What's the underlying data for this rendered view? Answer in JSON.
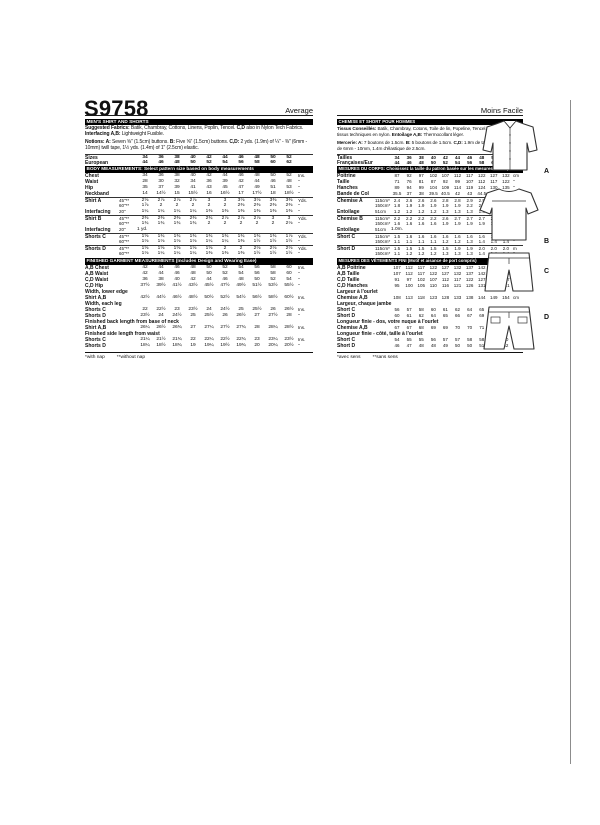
{
  "header": {
    "pattern_number": "S9758",
    "difficulty_en": "Average",
    "difficulty_fr": "Moins Facile"
  },
  "english": {
    "title_bar": "MEN'S SHIRT AND SHORTS",
    "fabrics": [
      {
        "b": 1,
        "t": "Suggested Fabrics: "
      },
      {
        "t": "Batik, Chambray, Cottons, Linens, Poplin, Tencel. "
      },
      {
        "b": 1,
        "t": "C,D"
      },
      {
        "t": " also in Nylon Tech Fabrics. "
      },
      {
        "b": 1,
        "t": "Interfacing A,B: "
      },
      {
        "t": "Lightweight Fusible."
      }
    ],
    "notions": [
      {
        "b": 1,
        "t": "Notions: A: "
      },
      {
        "t": "Seven ⅝\" (1.5cm) buttons. "
      },
      {
        "b": 1,
        "t": "B: "
      },
      {
        "t": "Five ⅝\" (1.5cm) buttons. "
      },
      {
        "b": 1,
        "t": "C,D: "
      },
      {
        "t": "2 yds. (1.9m) of ¼\" - ⅜\" (6mm - 10mm) twill tape, 1½ yds. (1.4m) of 1\" (2.5cm) elastic."
      }
    ],
    "rows": [
      {
        "t": "data",
        "b": true,
        "rule": true,
        "label": "Sizes",
        "sub": "",
        "values": [
          "34",
          "36",
          "38",
          "40",
          "42",
          "44",
          "46",
          "48",
          "50",
          "52"
        ],
        "unit": ""
      },
      {
        "t": "data",
        "b": true,
        "label": "European",
        "sub": "",
        "values": [
          "44",
          "46",
          "48",
          "50",
          "52",
          "54",
          "56",
          "58",
          "60",
          "62"
        ],
        "unit": ""
      },
      {
        "t": "bar",
        "text": "BODY MEASUREMENTS: Select pattern size based on body measurements"
      },
      {
        "t": "data",
        "label": "Chest",
        "sub": "",
        "values": [
          "34",
          "36",
          "38",
          "40",
          "42",
          "44",
          "46",
          "48",
          "50",
          "52"
        ],
        "unit": "Ins."
      },
      {
        "t": "data",
        "label": "Waist",
        "sub": "",
        "values": [
          "28",
          "30",
          "32",
          "34",
          "36",
          "39",
          "42",
          "44",
          "46",
          "48"
        ],
        "unit": "\""
      },
      {
        "t": "data",
        "label": "Hip",
        "sub": "",
        "values": [
          "35",
          "37",
          "39",
          "41",
          "43",
          "45",
          "47",
          "49",
          "51",
          "53"
        ],
        "unit": "\""
      },
      {
        "t": "data",
        "label": "Neckband",
        "sub": "",
        "values": [
          "14",
          "14½",
          "15",
          "15½",
          "16",
          "16½",
          "17",
          "17½",
          "18",
          "18½"
        ],
        "unit": "\""
      },
      {
        "t": "data",
        "rule": true,
        "label": "Shirt A",
        "sub": "45\"**",
        "values": [
          "2⅝",
          "2⅞",
          "2⅞",
          "2⅞",
          "3",
          "3",
          "3⅛",
          "3⅛",
          "3⅜",
          "3⅜"
        ],
        "unit": "Yds."
      },
      {
        "t": "data",
        "label": "",
        "sub": "60\"**",
        "values": [
          "1⅞",
          "2",
          "2",
          "2",
          "2",
          "2",
          "2⅜",
          "2⅜",
          "2⅜",
          "2⅜"
        ],
        "unit": "\""
      },
      {
        "t": "data",
        "label": "Interfacing",
        "sub": "20\"",
        "values": [
          "1¼",
          "1¼",
          "1¼",
          "1¼",
          "1⅜",
          "1⅜",
          "1⅜",
          "1⅜",
          "1⅜",
          "1⅜"
        ],
        "unit": "\""
      },
      {
        "t": "data",
        "rule": true,
        "label": "Shirt B",
        "sub": "45\"**",
        "values": [
          "2⅜",
          "2⅜",
          "2⅜",
          "2⅜",
          "2¾",
          "2⅞",
          "2⅞",
          "2⅞",
          "3",
          "3"
        ],
        "unit": "Yds."
      },
      {
        "t": "data",
        "label": "",
        "sub": "60\"**",
        "values": [
          "1¾",
          "1¾",
          "1¾",
          "1¾",
          "2",
          "2",
          "2",
          "2",
          "2",
          "2⅛"
        ],
        "unit": "\""
      },
      {
        "t": "data",
        "label": "Interfacing",
        "sub": "20\"",
        "span": "1 yd.",
        "unit": ""
      },
      {
        "t": "data",
        "rule": true,
        "label": "Shorts C",
        "sub": "45\"**",
        "values": [
          "1⅝",
          "1¾",
          "1¾",
          "1¾",
          "1¾",
          "1¾",
          "1¾",
          "1¾",
          "1¾",
          "1⅞"
        ],
        "unit": "Yds."
      },
      {
        "t": "data",
        "label": "",
        "sub": "60\"**",
        "values": [
          "1⅛",
          "1⅛",
          "1⅛",
          "1⅛",
          "1¼",
          "1¼",
          "1⅜",
          "1½",
          "1½",
          "1½"
        ],
        "unit": "\""
      },
      {
        "t": "data",
        "rule": true,
        "label": "Shorts D",
        "sub": "45\"**",
        "values": [
          "1⅝",
          "1⅝",
          "1⅝",
          "1⅝",
          "1⅝",
          "2",
          "2",
          "2⅛",
          "2⅛",
          "2⅛"
        ],
        "unit": "Yds."
      },
      {
        "t": "data",
        "label": "",
        "sub": "60\"**",
        "values": [
          "1⅛",
          "1¼",
          "1¼",
          "1¼",
          "1⅜",
          "1⅜",
          "1⅜",
          "1½",
          "1½",
          "1½"
        ],
        "unit": "\""
      },
      {
        "t": "bar",
        "text": "FINISHED GARMENT MEASUREMENTS (Includes Design and Wearing Ease)"
      },
      {
        "t": "data",
        "label": "A,B Chest",
        "sub": "",
        "values": [
          "42",
          "44",
          "46",
          "48",
          "50",
          "52",
          "54",
          "56",
          "58",
          "60"
        ],
        "unit": "Ins."
      },
      {
        "t": "data",
        "label": "A,B Waist",
        "sub": "",
        "values": [
          "42",
          "44",
          "46",
          "48",
          "50",
          "52",
          "54",
          "56",
          "58",
          "60"
        ],
        "unit": "\""
      },
      {
        "t": "data",
        "label": "C,D Waist",
        "sub": "",
        "values": [
          "36",
          "38",
          "40",
          "42",
          "44",
          "46",
          "48",
          "50",
          "52",
          "54"
        ],
        "unit": "\""
      },
      {
        "t": "data",
        "label": "C,D Hip",
        "sub": "",
        "values": [
          "37½",
          "39½",
          "41½",
          "43½",
          "45½",
          "47½",
          "49½",
          "51½",
          "53½",
          "55½"
        ],
        "unit": "\""
      },
      {
        "t": "sub",
        "text": "Width, lower edge"
      },
      {
        "t": "data",
        "label": "Shirt A,B",
        "sub": "",
        "values": [
          "42½",
          "44½",
          "46½",
          "48½",
          "50½",
          "52½",
          "54½",
          "56½",
          "58½",
          "60½"
        ],
        "unit": "Ins."
      },
      {
        "t": "sub",
        "text": "Width, each leg"
      },
      {
        "t": "data",
        "label": "Shorts C",
        "sub": "",
        "values": [
          "22",
          "22½",
          "23",
          "23½",
          "24",
          "24½",
          "25",
          "25½",
          "26",
          "26½"
        ],
        "unit": "Ins."
      },
      {
        "t": "data",
        "label": "Shorts D",
        "sub": "",
        "values": [
          "23½",
          "24",
          "24½",
          "25",
          "25½",
          "26",
          "26½",
          "27",
          "27½",
          "28"
        ],
        "unit": "\""
      },
      {
        "t": "sub",
        "text": "Finished back length from base of neck"
      },
      {
        "t": "data",
        "label": "Shirt A,B",
        "sub": "",
        "values": [
          "26¼",
          "26½",
          "26¾",
          "27",
          "27¼",
          "27½",
          "27¾",
          "28",
          "28¼",
          "28½"
        ],
        "unit": "Ins."
      },
      {
        "t": "sub",
        "text": "Finished side length from waist"
      },
      {
        "t": "data",
        "label": "Shorts C",
        "sub": "",
        "values": [
          "21¼",
          "21½",
          "21¾",
          "22",
          "22¼",
          "22½",
          "22¾",
          "23",
          "23¼",
          "23½"
        ],
        "unit": "Ins."
      },
      {
        "t": "data",
        "label": "Shorts D",
        "sub": "",
        "values": [
          "18¼",
          "18½",
          "18¾",
          "19",
          "19¼",
          "19½",
          "19¾",
          "20",
          "20¼",
          "20½"
        ],
        "unit": "\""
      },
      {
        "t": "note",
        "n1": "*with nap",
        "n2": "**without nap"
      }
    ]
  },
  "french": {
    "title_bar": "CHEMISE ET SHORT POUR HOMMES",
    "fabrics": [
      {
        "b": 1,
        "t": "Tissus Conseillés: "
      },
      {
        "t": "Batik, Chambray, Cotons, Toile de lin, Popeline, Tencel. "
      },
      {
        "b": 1,
        "t": "C,D"
      },
      {
        "t": " aussi en tissus techniques en nylon. "
      },
      {
        "b": 1,
        "t": "Entoilage A,B: "
      },
      {
        "t": "Thermocollant léger."
      }
    ],
    "notions": [
      {
        "b": 1,
        "t": "Mercerie: A: "
      },
      {
        "t": "7 boutons de 1.5cm. "
      },
      {
        "b": 1,
        "t": "B: "
      },
      {
        "t": "5 boutons de 1.5cm. "
      },
      {
        "b": 1,
        "t": "C,D: "
      },
      {
        "t": "1.9m de talonnette de coton de 6mm - 10mm, 1.4m d'élastique de 2.5cm."
      }
    ],
    "rows": [
      {
        "t": "data",
        "b": true,
        "rule": true,
        "label": "Tailles",
        "sub": "",
        "values": [
          "34",
          "36",
          "38",
          "40",
          "42",
          "44",
          "46",
          "48",
          "50",
          "52"
        ],
        "unit": ""
      },
      {
        "t": "data",
        "b": true,
        "label": "Françaises/Eur",
        "sub": "",
        "values": [
          "44",
          "46",
          "48",
          "50",
          "52",
          "54",
          "56",
          "58",
          "60",
          "62"
        ],
        "unit": ""
      },
      {
        "t": "bar",
        "text": "MESURES DU CORPS: Choisissez la taille du patron basée sur les mesures du corps"
      },
      {
        "t": "data",
        "label": "Poitrine",
        "sub": "",
        "values": [
          "87",
          "92",
          "97",
          "102",
          "107",
          "112",
          "117",
          "122",
          "127",
          "132"
        ],
        "unit": "cm"
      },
      {
        "t": "data",
        "label": "Taille",
        "sub": "",
        "values": [
          "71",
          "76",
          "81",
          "87",
          "92",
          "99",
          "107",
          "112",
          "117",
          "122"
        ],
        "unit": "\""
      },
      {
        "t": "data",
        "label": "Hanches",
        "sub": "",
        "values": [
          "89",
          "94",
          "99",
          "104",
          "109",
          "114",
          "119",
          "124",
          "130",
          "135"
        ],
        "unit": "\""
      },
      {
        "t": "data",
        "label": "Bande de Col",
        "sub": "",
        "values": [
          "35.5",
          "37",
          "38",
          "39.5",
          "40.5",
          "42",
          "43",
          "44.5",
          "45.5",
          "47"
        ],
        "unit": "\""
      },
      {
        "t": "data",
        "rule": true,
        "label": "Chemise A",
        "sub": "115cm*",
        "values": [
          "2.4",
          "2.6",
          "2.6",
          "2.6",
          "2.8",
          "2.8",
          "2.9",
          "2.9",
          "3.0",
          "3.0"
        ],
        "unit": "m"
      },
      {
        "t": "data",
        "label": "",
        "sub": "150cm*",
        "values": [
          "1.8",
          "1.9",
          "1.9",
          "1.9",
          "1.9",
          "1.9",
          "2.2",
          "2.2",
          "2.2",
          "2.2"
        ],
        "unit": "\""
      },
      {
        "t": "data",
        "label": "Entoilage",
        "sub": "51cm",
        "values": [
          "1.2",
          "1.2",
          "1.2",
          "1.2",
          "1.3",
          "1.3",
          "1.3",
          "1.3",
          "1.3",
          "1.3"
        ],
        "unit": "\""
      },
      {
        "t": "data",
        "rule": true,
        "label": "Chemise B",
        "sub": "115cm*",
        "values": [
          "2.2",
          "2.2",
          "2.2",
          "2.2",
          "2.6",
          "2.7",
          "2.7",
          "2.7",
          "2.8",
          "2.8"
        ],
        "unit": "m"
      },
      {
        "t": "data",
        "label": "",
        "sub": "150cm*",
        "values": [
          "1.6",
          "1.6",
          "1.6",
          "1.6",
          "1.9",
          "1.9",
          "1.9",
          "1.9",
          "1.9",
          "2.0"
        ],
        "unit": "\""
      },
      {
        "t": "data",
        "label": "Entoilage",
        "sub": "51cm",
        "span": "1.0m.",
        "unit": ""
      },
      {
        "t": "data",
        "rule": true,
        "label": "Short C",
        "sub": "115cm*",
        "values": [
          "1.5",
          "1.6",
          "1.6",
          "1.6",
          "1.6",
          "1.6",
          "1.6",
          "1.6",
          "1.6",
          "1.8"
        ],
        "unit": "m"
      },
      {
        "t": "data",
        "label": "",
        "sub": "150cm*",
        "values": [
          "1.1",
          "1.1",
          "1.1",
          "1.1",
          "1.2",
          "1.2",
          "1.3",
          "1.4",
          "1.4",
          "1.4"
        ],
        "unit": "\""
      },
      {
        "t": "data",
        "rule": true,
        "label": "Short D",
        "sub": "115cm*",
        "values": [
          "1.5",
          "1.5",
          "1.5",
          "1.5",
          "1.5",
          "1.9",
          "1.9",
          "2.0",
          "2.0",
          "2.0"
        ],
        "unit": "m"
      },
      {
        "t": "data",
        "label": "",
        "sub": "150cm*",
        "values": [
          "1.1",
          "1.2",
          "1.2",
          "1.2",
          "1.3",
          "1.3",
          "1.3",
          "1.4",
          "1.4",
          "1.4"
        ],
        "unit": "\""
      },
      {
        "t": "bar",
        "text": "MESURES DES VÊTEMENTS FINI (Motif et aisance de port compris)"
      },
      {
        "t": "data",
        "label": "A,B Poitrine",
        "sub": "",
        "values": [
          "107",
          "112",
          "117",
          "122",
          "127",
          "132",
          "137",
          "142",
          "147",
          "152"
        ],
        "unit": "cm"
      },
      {
        "t": "data",
        "label": "A,B Taille",
        "sub": "",
        "values": [
          "107",
          "112",
          "117",
          "122",
          "127",
          "132",
          "137",
          "142",
          "147",
          "152"
        ],
        "unit": "\""
      },
      {
        "t": "data",
        "label": "C,D Taille",
        "sub": "",
        "values": [
          "91",
          "97",
          "102",
          "107",
          "112",
          "117",
          "122",
          "127",
          "132",
          "137"
        ],
        "unit": "\""
      },
      {
        "t": "data",
        "label": "C,D Hanches",
        "sub": "",
        "values": [
          "95",
          "100",
          "105",
          "110",
          "116",
          "121",
          "126",
          "131",
          "136",
          "141"
        ],
        "unit": "\""
      },
      {
        "t": "sub",
        "text": "Largeur à l'ourlet"
      },
      {
        "t": "data",
        "label": "Chemise A,B",
        "sub": "",
        "values": [
          "108",
          "113",
          "118",
          "123",
          "128",
          "133",
          "138",
          "144",
          "149",
          "154"
        ],
        "unit": "cm"
      },
      {
        "t": "sub",
        "text": "Largeur, chaque jambe"
      },
      {
        "t": "data",
        "label": "Short C",
        "sub": "",
        "values": [
          "56",
          "57",
          "58",
          "60",
          "61",
          "62",
          "64",
          "65",
          "66",
          "67"
        ],
        "unit": "cm"
      },
      {
        "t": "data",
        "label": "Short D",
        "sub": "",
        "values": [
          "60",
          "61",
          "62",
          "64",
          "65",
          "66",
          "67",
          "69",
          "70",
          "71"
        ],
        "unit": "\""
      },
      {
        "t": "sub",
        "text": "Longueur finie - dos, votre nuque à l'ourlet"
      },
      {
        "t": "data",
        "label": "Chemise A,B",
        "sub": "",
        "values": [
          "67",
          "67",
          "68",
          "69",
          "69",
          "70",
          "70",
          "71",
          "72",
          "72"
        ],
        "unit": "cm"
      },
      {
        "t": "sub",
        "text": "Longueur finie - côté, taille à l'ourlet"
      },
      {
        "t": "data",
        "label": "Short C",
        "sub": "",
        "values": [
          "54",
          "55",
          "55",
          "56",
          "57",
          "57",
          "58",
          "58",
          "59",
          "60"
        ],
        "unit": "cm"
      },
      {
        "t": "data",
        "label": "Short D",
        "sub": "",
        "values": [
          "46",
          "47",
          "48",
          "48",
          "49",
          "50",
          "50",
          "51",
          "51",
          "52"
        ],
        "unit": "\""
      },
      {
        "t": "note",
        "n1": "*avec sens",
        "n2": "**sans sens"
      }
    ]
  },
  "figures": {
    "labels": [
      "A",
      "B",
      "C",
      "D"
    ]
  }
}
